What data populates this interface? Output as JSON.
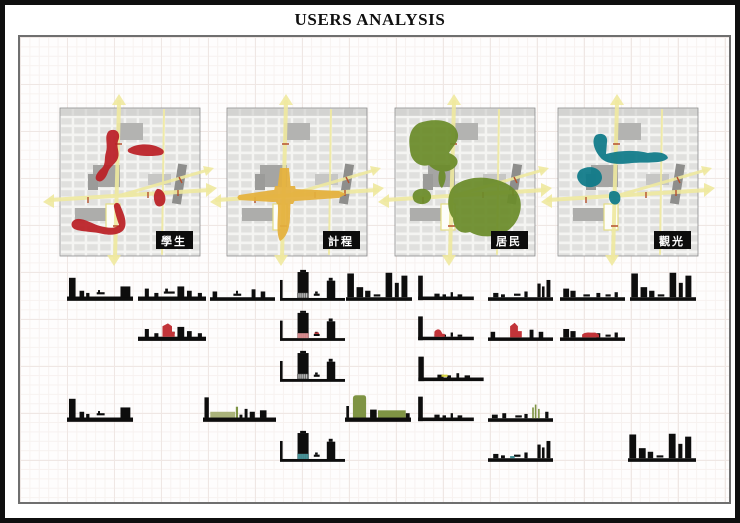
{
  "title": "USERS ANALYSIS",
  "maps": [
    {
      "id": "students",
      "label": "學生",
      "color": "#bb2026"
    },
    {
      "id": "taxi",
      "label": "計程",
      "color": "#e5b13d"
    },
    {
      "id": "residents",
      "label": "居民",
      "color": "#6b8c2a"
    },
    {
      "id": "tourists",
      "label": "觀光",
      "color": "#0e7a89"
    }
  ],
  "palette": {
    "road_yellow": "#efe99f",
    "silhouette_black": "#0d0d0d",
    "highlight_red": "#c23439",
    "highlight_pink": "#d9878b",
    "highlight_olive": "#7f9444",
    "highlight_olive_light": "#aab37b",
    "highlight_teal": "#3f8e93",
    "highlight_yellow": "#d6d23e",
    "label_box_black": "#0c0c0c",
    "label_text_white": "#ffffff"
  },
  "elevations": {
    "rows": [
      {
        "row": 1,
        "strips": 9,
        "highlight_colors": []
      },
      {
        "row": 2,
        "strips": 5,
        "highlight_colors": [
          "red"
        ]
      },
      {
        "row": 3,
        "strips": 2,
        "highlight_colors": [
          "yellow"
        ]
      },
      {
        "row": 4,
        "strips": 5,
        "highlight_colors": [
          "olive"
        ]
      },
      {
        "row": 5,
        "strips": 3,
        "highlight_colors": [
          "teal"
        ]
      }
    ]
  }
}
